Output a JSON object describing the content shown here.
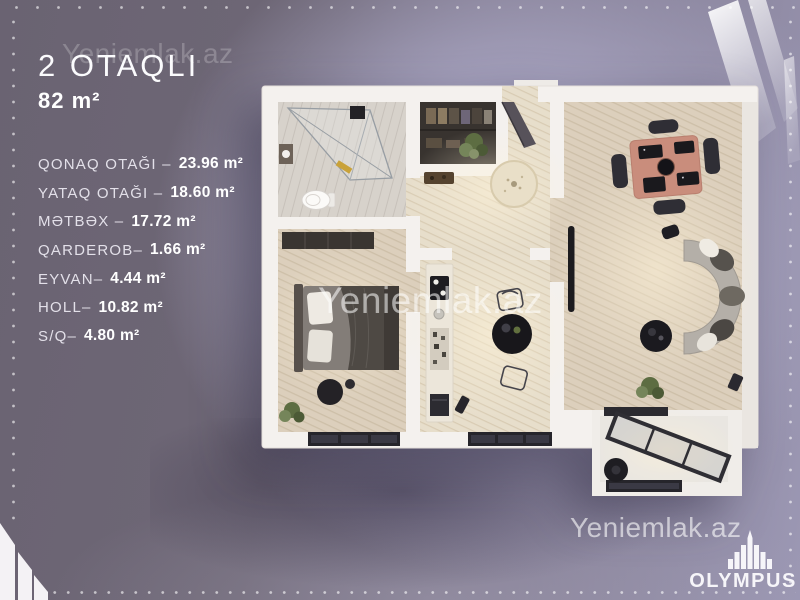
{
  "title": {
    "rooms_count": "2 OTAQLI",
    "total_area": "82 m²"
  },
  "room_list": [
    {
      "label": "QONAQ OTAĞI –",
      "value": "23.96 m²"
    },
    {
      "label": "YATAQ OTAĞI –",
      "value": "18.60 m²"
    },
    {
      "label": "MƏTBƏX –",
      "value": "17.72 m²"
    },
    {
      "label": "QARDEROB–",
      "value": "1.66 m²"
    },
    {
      "label": "EYVAN–",
      "value": "4.44 m²"
    },
    {
      "label": "HOLL–",
      "value": "10.82 m²"
    },
    {
      "label": "S/Q–",
      "value": "4.80 m²"
    }
  ],
  "watermark": {
    "text": "Yeniemlak.az"
  },
  "brand": {
    "name": "OLYMPUS"
  },
  "colors": {
    "background_dark": "#6a6372",
    "background_light": "#b9b6d2",
    "wall": "#f4f1ee",
    "floor_wood": "#dccfbc",
    "window_frame": "#26252b",
    "text": "#ffffff"
  }
}
